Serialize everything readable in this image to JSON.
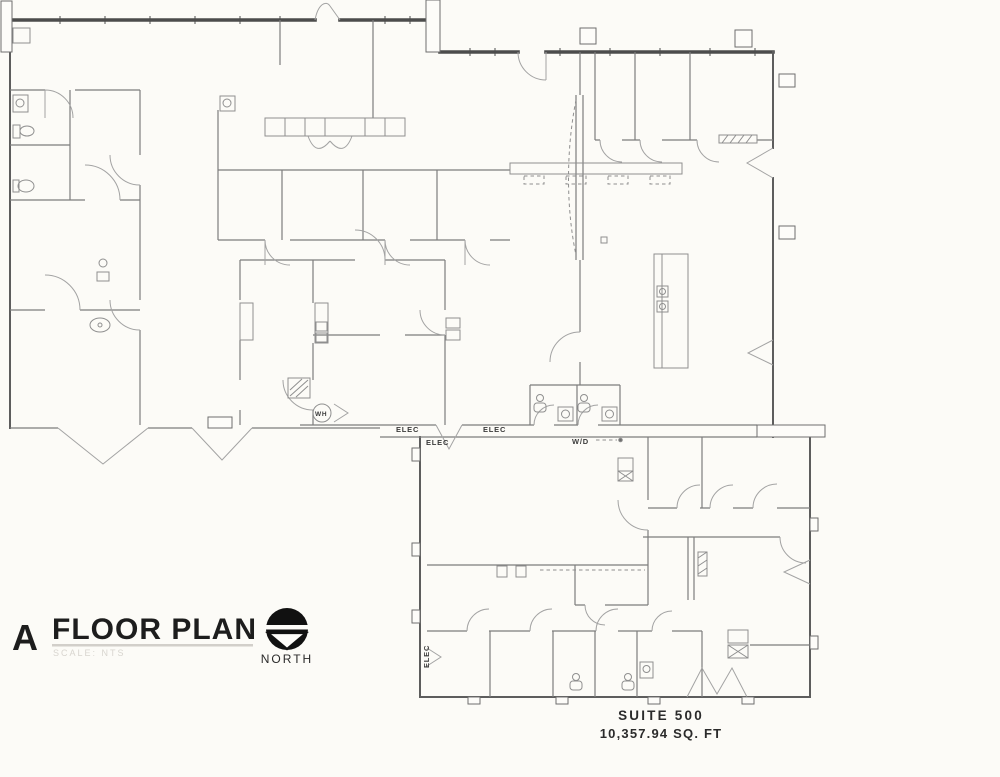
{
  "background_color": "#fcfbf7",
  "ink_color": "#1d1d1d",
  "wall_color": "#4c4c4c",
  "line_color": "#7d7d7d",
  "title_block": {
    "sheet_letter": "A",
    "title": "FLOOR PLAN",
    "scale_note": "SCALE: NTS",
    "north_label": "NORTH"
  },
  "suite_info": {
    "name": "SUITE 500",
    "area": "10,357.94 SQ. FT"
  },
  "plan": {
    "labels": [
      {
        "text": "ELEC",
        "x": 396,
        "y": 432,
        "rot": 0,
        "size": 7.5
      },
      {
        "text": "ELEC",
        "x": 426,
        "y": 445,
        "rot": 0,
        "size": 7.5
      },
      {
        "text": "ELEC",
        "x": 483,
        "y": 432,
        "rot": 0,
        "size": 7.5
      },
      {
        "text": "W/D",
        "x": 572,
        "y": 444,
        "rot": 0,
        "size": 7.5
      },
      {
        "text": "ELEC",
        "x": 429,
        "y": 668,
        "rot": -90,
        "size": 7.5
      },
      {
        "text": "WH",
        "x": 315,
        "y": 416,
        "rot": 0,
        "size": 6.5
      }
    ]
  }
}
